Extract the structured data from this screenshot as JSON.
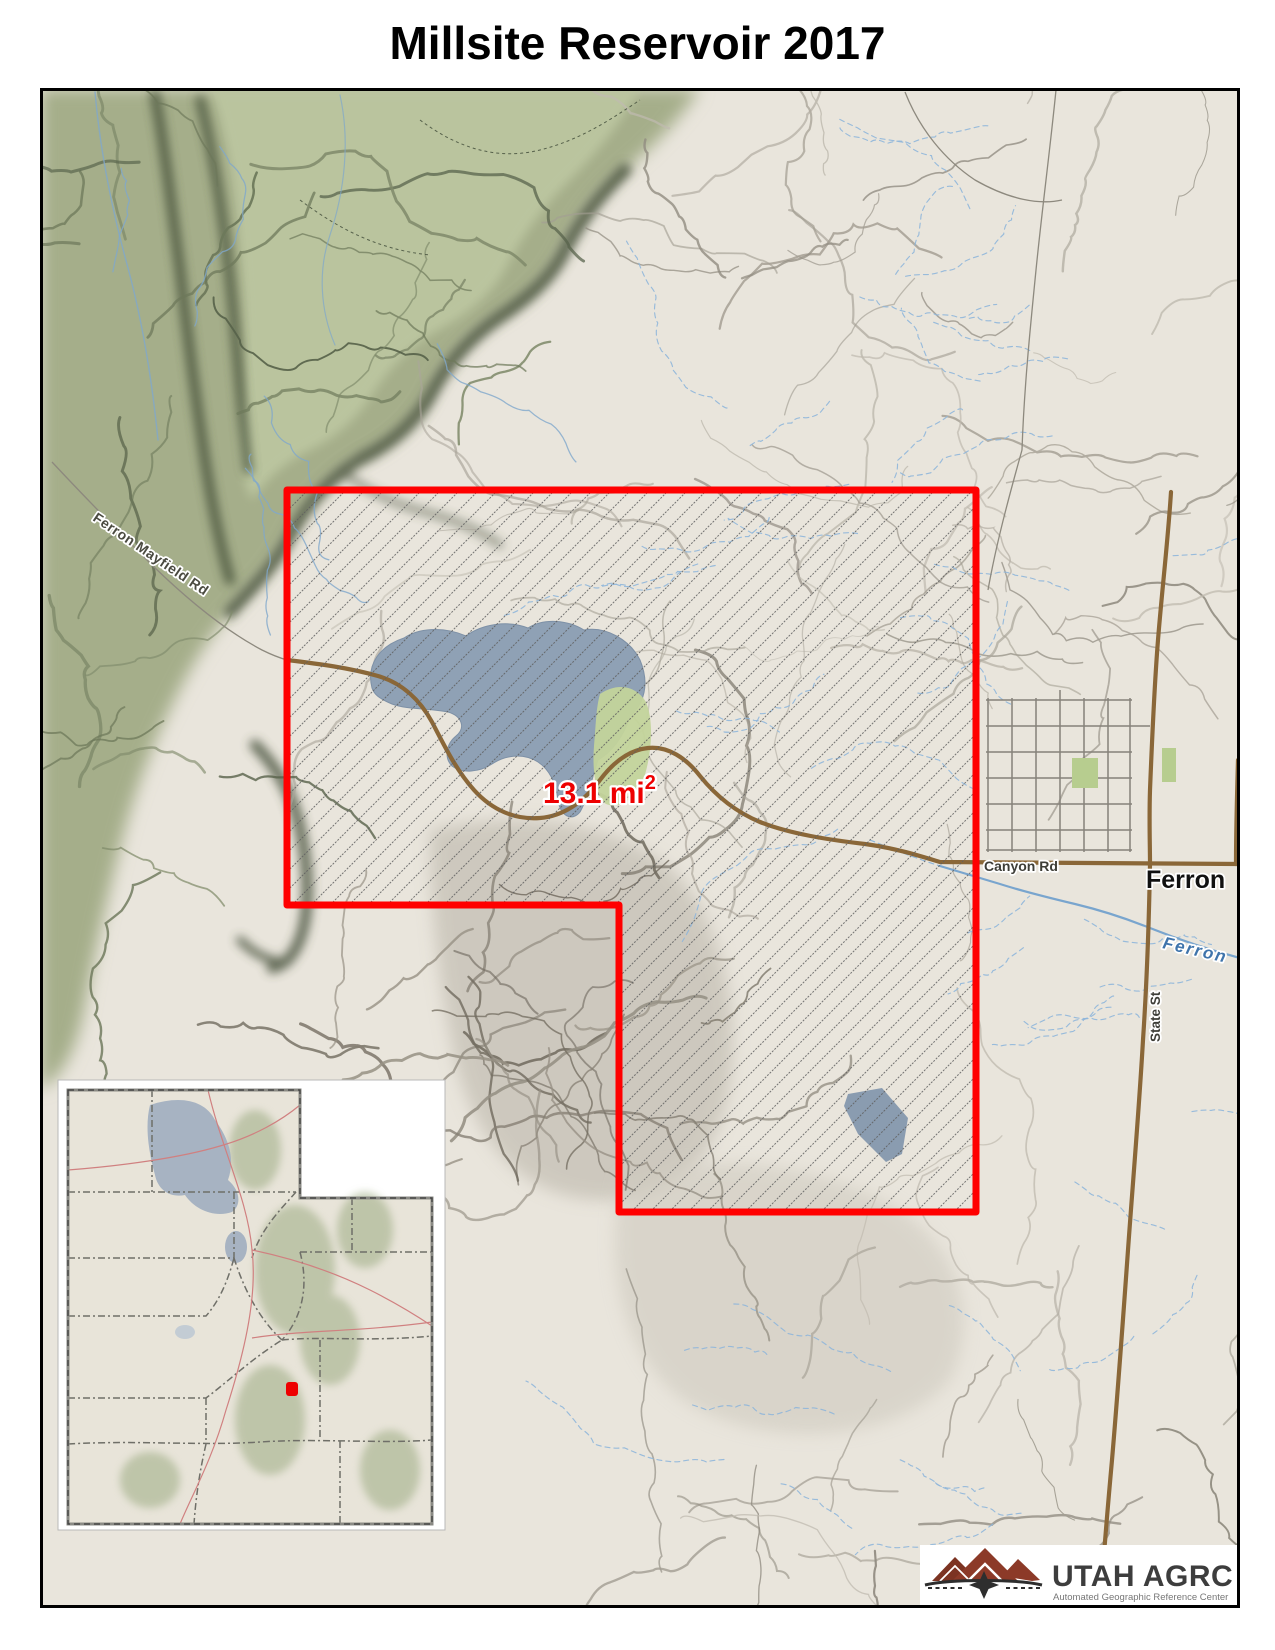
{
  "title": "Millsite Reservoir 2017",
  "map": {
    "area_annotation": {
      "text": "13.1 mi",
      "superscript": "2",
      "color": "#ee0000"
    },
    "labels": {
      "ferron_mayfield_rd": "Ferron Mayfield Rd",
      "canyon_rd": "Canyon Rd",
      "ferron_town": "Ferron",
      "ferron_creek": "Ferron",
      "state_st": "State St"
    },
    "colors": {
      "boundary": "#ff0000",
      "water": "#8fa1b5",
      "wetland": "#c3d49b",
      "road_brown": "#8a6738",
      "terrain_green": "#a5ae8a"
    }
  },
  "inset": {
    "marker_color": "#ee0000",
    "lake_color": "#a7b3c2"
  },
  "logo": {
    "title": "UTAH AGRC",
    "tagline": "Automated Geographic Reference Center",
    "brand_color": "#8c3a28"
  }
}
